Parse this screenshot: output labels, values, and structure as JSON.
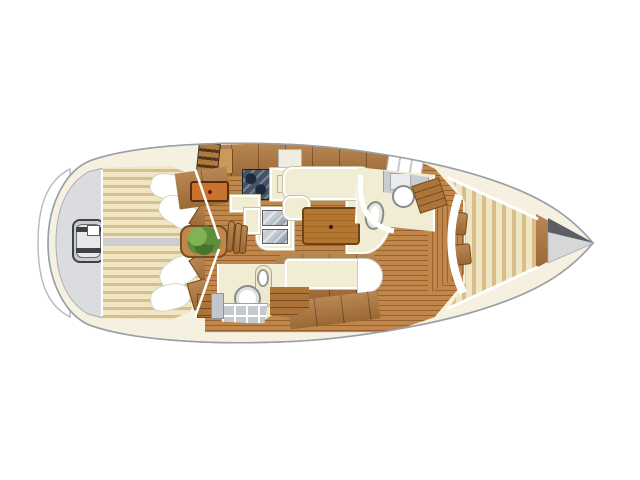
{
  "diagram": {
    "kind": "sailboat-interior-floorplan",
    "view": "top-down",
    "bow_direction": "right",
    "visible_text": "none"
  },
  "regions": {
    "swimPlatform": {
      "label": "Swim platform / transom"
    },
    "transomLocker": {
      "label": "Transom locker with ladder"
    },
    "aftCabinPort": {
      "label": "Aft cabin double berth (port)"
    },
    "aftCabinStarboard": {
      "label": "Aft cabin double berth (starboard)"
    },
    "companionway": {
      "label": "Companionway steps"
    },
    "navStation": {
      "label": "Chart table with drawer"
    },
    "galleyStove": {
      "label": "Galley stove"
    },
    "galleySink": {
      "label": "Galley twin sinks"
    },
    "galleyCounter": {
      "label": "Galley counter"
    },
    "saloonSettee": {
      "label": "U-shaped saloon settee"
    },
    "saloonTable": {
      "label": "Saloon table"
    },
    "saloonBench": {
      "label": "Straight settee"
    },
    "plantTable": {
      "label": "Saloon table with plant"
    },
    "aftHead": {
      "label": "Aft head with toilet, sink and shower"
    },
    "forwardHead": {
      "label": "Forward head with toilet, sink and shower"
    },
    "vBerth": {
      "label": "Forward cabin V-berth"
    },
    "bow": {
      "label": "Bow / anchor locker"
    }
  },
  "colors": {
    "deck": "#F5F0DF",
    "hullLine": "#9AA0A6",
    "platform": "#FFFFFF",
    "platformLine": "#B6B9BD",
    "transom": "#DBDCDF",
    "transomLine": "#A9ACB0",
    "stripeLight": "#EFE7C3",
    "stripeDark": "#D9BE8C",
    "floorWood": "#C1874A",
    "floorLine": "#97622F",
    "cabinetWood": "#AC7439",
    "cabinetLine": "#76491F",
    "tableWood": "#B5762F",
    "tableLine": "#6A4316",
    "drawerOrange": "#C8722E",
    "drawerDot": "#7E120C",
    "cream": "#F1ECD4",
    "creamLine": "#C9C2A2",
    "grayFixture": "#C9CDD2",
    "sinkGrayB": "#8C96A1",
    "stoveDark": "#44556A",
    "stoveBurner": "#1F2B3A",
    "tile": "#C6CAD0",
    "bowDark": "#5B5F64",
    "bowLight": "#D6D7D9",
    "plantDark": "#49742E",
    "plantMid": "#5D8F3C",
    "plantLight": "#7FB353",
    "ladderGray": "#C9CBCE",
    "ladderInner": "#E6E7E9"
  }
}
